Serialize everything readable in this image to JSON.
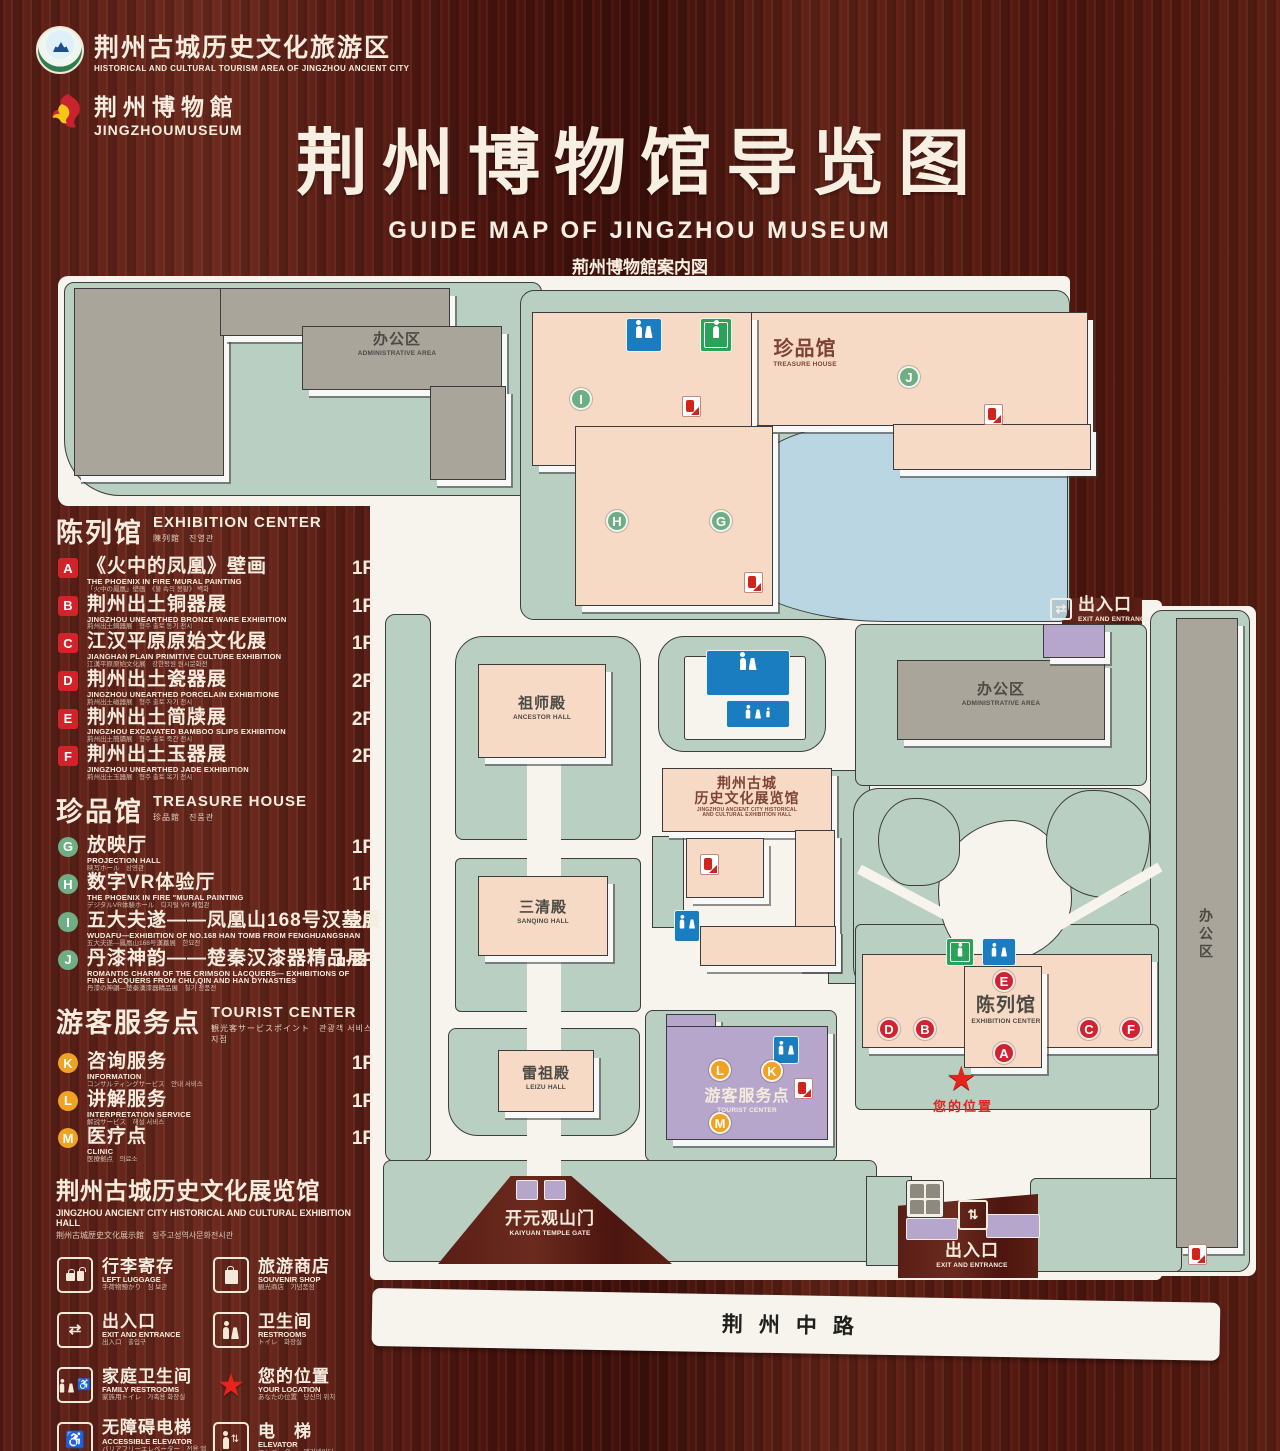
{
  "header": {
    "logo1": {
      "title": "荆州古城历史文化旅游区",
      "subtitle": "HISTORICAL AND CULTURAL TOURISM AREA OF JINGZHOU ANCIENT CITY"
    },
    "logo2": {
      "title": "荆州博物館",
      "subtitle": "JINGZHOUMUSEUM"
    },
    "title": "荆州博物馆导览图",
    "subtitle_en": "GUIDE MAP OF JINGZHOU MUSEUM",
    "subtitle_ja": "荊州博物館案内図",
    "subtitle_ko": "징주박물관 안내도"
  },
  "colors": {
    "marker_red": "#cf2430",
    "marker_green": "#6fae85",
    "marker_yellow": "#f0a322",
    "map_green": "#b9cfc2",
    "building_pink": "#f6dac6",
    "building_gray": "#a9a59b",
    "pond_blue": "#bad6e2",
    "purple": "#b7a6cb",
    "sign_blue": "#1a7dc0",
    "sign_green": "#2aa257"
  },
  "legend": {
    "sections": [
      {
        "title_zh": "陈列馆",
        "title_en": "EXHIBITION CENTER",
        "title_sub": "陳列館　진열관",
        "marker_shape": "square",
        "marker_color": "#d2232a",
        "items": [
          {
            "letter": "A",
            "zh": "《火中的凤凰》壁画",
            "en": "THE PHOENIX IN FIRE 'MURAL PAINTING",
            "sub": "「火中の鳳凰」壁画　《불 속의 봉황》 벽화",
            "floor": "1F"
          },
          {
            "letter": "B",
            "zh": "荆州出土铜器展",
            "en": "JINGZHOU UNEARTHED BRONZE WARE EXHIBITION",
            "sub": "荊州出土銅器展　형주 출토 동기 전시",
            "floor": "1F"
          },
          {
            "letter": "C",
            "zh": "江汉平原原始文化展",
            "en": "JIANGHAN PLAIN PRIMITIVE CULTURE EXHIBITION",
            "sub": "江漢平原原始文化展　강한평원 원시문화전",
            "floor": "1F"
          },
          {
            "letter": "D",
            "zh": "荆州出土瓷器展",
            "en": "JINGZHOU UNEARTHED PORCELAIN EXHIBITIONE",
            "sub": "荊州出土磁器展　형주 출토 자기 전시",
            "floor": "2F"
          },
          {
            "letter": "E",
            "zh": "荆州出土简牍展",
            "en": "JINGZHOU EXCAVATED BAMBOO SLIPS EXHIBITION",
            "sub": "荊州出土簡牘展　형주 출토 죽간 전시",
            "floor": "2F"
          },
          {
            "letter": "F",
            "zh": "荆州出土玉器展",
            "en": "JINGZHOU UNEARTHED JADE EXHIBITION",
            "sub": "荊州出土玉器展　형주 출토 옥기 전시",
            "floor": "2F"
          }
        ]
      },
      {
        "title_zh": "珍品馆",
        "title_en": "TREASURE HOUSE",
        "title_sub": "珍品館　진품관",
        "marker_shape": "circle",
        "marker_color": "#6fae85",
        "items": [
          {
            "letter": "G",
            "zh": "放映厅",
            "en": "PROJECTION HALL",
            "sub": "映写ホール　상영관",
            "floor": "1F"
          },
          {
            "letter": "H",
            "zh": "数字VR体验厅",
            "en": "THE PHOENIX IN FIRE \"MURAL PAINTING",
            "sub": "デジタルVR体験ホール　디지털 VR 체험관",
            "floor": "1F"
          },
          {
            "letter": "I",
            "zh": "五大夫遂——凤凰山168号汉墓展",
            "en": "WUDAFU—EXHIBITION OF NO.168 HAN TOMB FROM FENGHUANGSHAN",
            "sub": "五大夫遂—鳳凰山168号漢墓展　한묘전",
            "floor": "2F"
          },
          {
            "letter": "J",
            "zh": "丹漆神韵——楚秦汉漆器精品展",
            "en": "ROMANTIC CHARM OF THE CRIMSON LACQUERS— EXHIBITIONS OF FINE LACQUERS FROM CHU,QIN AND HAN DYNASTIES",
            "sub": "丹漆の神韻—楚秦漢漆器精品展　칠기 정품전",
            "floor": "1-2F"
          }
        ]
      },
      {
        "title_zh": "游客服务点",
        "title_en": "TOURIST CENTER",
        "title_sub": "観光客サービスポイント　관광객 서비스 지점",
        "marker_shape": "circle",
        "marker_color": "#f0a322",
        "items": [
          {
            "letter": "K",
            "zh": "咨询服务",
            "en": "INFORMATION",
            "sub": "コンサルティングサービス　안내 서비스",
            "floor": "1F"
          },
          {
            "letter": "L",
            "zh": "讲解服务",
            "en": "INTERPRETATION SERVICE",
            "sub": "解説サービス　해설 서비스",
            "floor": "1F"
          },
          {
            "letter": "M",
            "zh": "医疗点",
            "en": "CLINIC",
            "sub": "医療拠点　의료소",
            "floor": "1F"
          }
        ]
      }
    ],
    "hall_note": {
      "zh": "荆州古城历史文化展览馆",
      "en": "JINGZHOU ANCIENT CITY HISTORICAL AND CULTURAL EXHIBITION HALL",
      "sub": "荆州古城歴史文化展示館　징주고성역사문화전시관"
    },
    "icons": [
      {
        "type": "luggage",
        "zh": "行李寄存",
        "en": "LEFT LUGGAGE",
        "sub": "手荷物預かり　짐 보관"
      },
      {
        "type": "souvenir",
        "zh": "旅游商店",
        "en": "SOUVENIR SHOP",
        "sub": "観光商店　기념품점"
      },
      {
        "type": "exit",
        "zh": "出入口",
        "en": "EXIT AND ENTRANCE",
        "sub": "出入口　출입구"
      },
      {
        "type": "restroom",
        "zh": "卫生间",
        "en": "RESTROOMS",
        "sub": "トイレ　화장실"
      },
      {
        "type": "family",
        "zh": "家庭卫生间",
        "en": "FAMILY RESTROOMS",
        "sub": "家族用トイレ　가족용 화장실"
      },
      {
        "type": "location",
        "zh": "您的位置",
        "en": "YOUR LOCATION",
        "sub": "あなたの位置　당신의 위치"
      },
      {
        "type": "accessible",
        "zh": "无障碍电梯",
        "en": "ACCESSIBLE ELEVATOR",
        "sub": "バリアフリーエレベーター　전용 엘리베이터"
      },
      {
        "type": "elevator",
        "zh": "电　梯",
        "en": "ELEVATOR",
        "sub": "エレベーター　엘리베이터"
      },
      {
        "type": "display",
        "zh": "展示区域",
        "en": "DISPLAY AREA",
        "sub": "展示エリア　전시 영역"
      },
      {
        "type": "office",
        "zh": "办公区域",
        "en": "OFFICE AREA",
        "sub": "オフィスエリア　사무실 구역"
      }
    ]
  },
  "map": {
    "labels": {
      "office_top": {
        "zh": "办公区",
        "en": "ADMINISTRATIVE AREA"
      },
      "treasure": {
        "zh": "珍品馆",
        "en": "TREASURE HOUSE"
      },
      "exit_right": {
        "zh": "出入口",
        "en": "EXIT AND ENTRANCE"
      },
      "office_right": {
        "zh": "办公区",
        "en": "ADMINISTRATIVE AREA"
      },
      "ancestor": {
        "zh": "祖师殿",
        "en": "ANCESTOR HALL"
      },
      "sanqing": {
        "zh": "三清殿",
        "en": "SANQING HALL"
      },
      "exhibit_hall": {
        "zh1": "荆州古城",
        "zh2": "历史文化展览馆",
        "en1": "JINGZHOU ANCIENT CITY HISTORICAL",
        "en2": "AND CULTURAL EXHIBITION HALL"
      },
      "leizu": {
        "zh": "雷祖殿",
        "en": "LEIZU HALL"
      },
      "exhibition": {
        "zh": "陈列馆",
        "en": "EXHIBITION CENTER"
      },
      "tourist": {
        "zh": "游客服务点",
        "en": "TOURIST CENTER"
      },
      "your_location": "您的位置",
      "kaiyuan": {
        "zh": "开元观山门",
        "en": "KAIYUAN TEMPLE GATE"
      },
      "exit_bottom": {
        "zh": "出入口",
        "en": "EXIT AND ENTRANCE"
      },
      "office_strip": {
        "zh": "办公区",
        "en": "ADMINISTRATIVE AREA"
      },
      "road": "荆州中路"
    },
    "markers": {
      "A": "A",
      "B": "B",
      "C": "C",
      "D": "D",
      "E": "E",
      "F": "F",
      "G": "G",
      "H": "H",
      "I": "I",
      "J": "J",
      "K": "K",
      "L": "L",
      "M": "M"
    }
  }
}
